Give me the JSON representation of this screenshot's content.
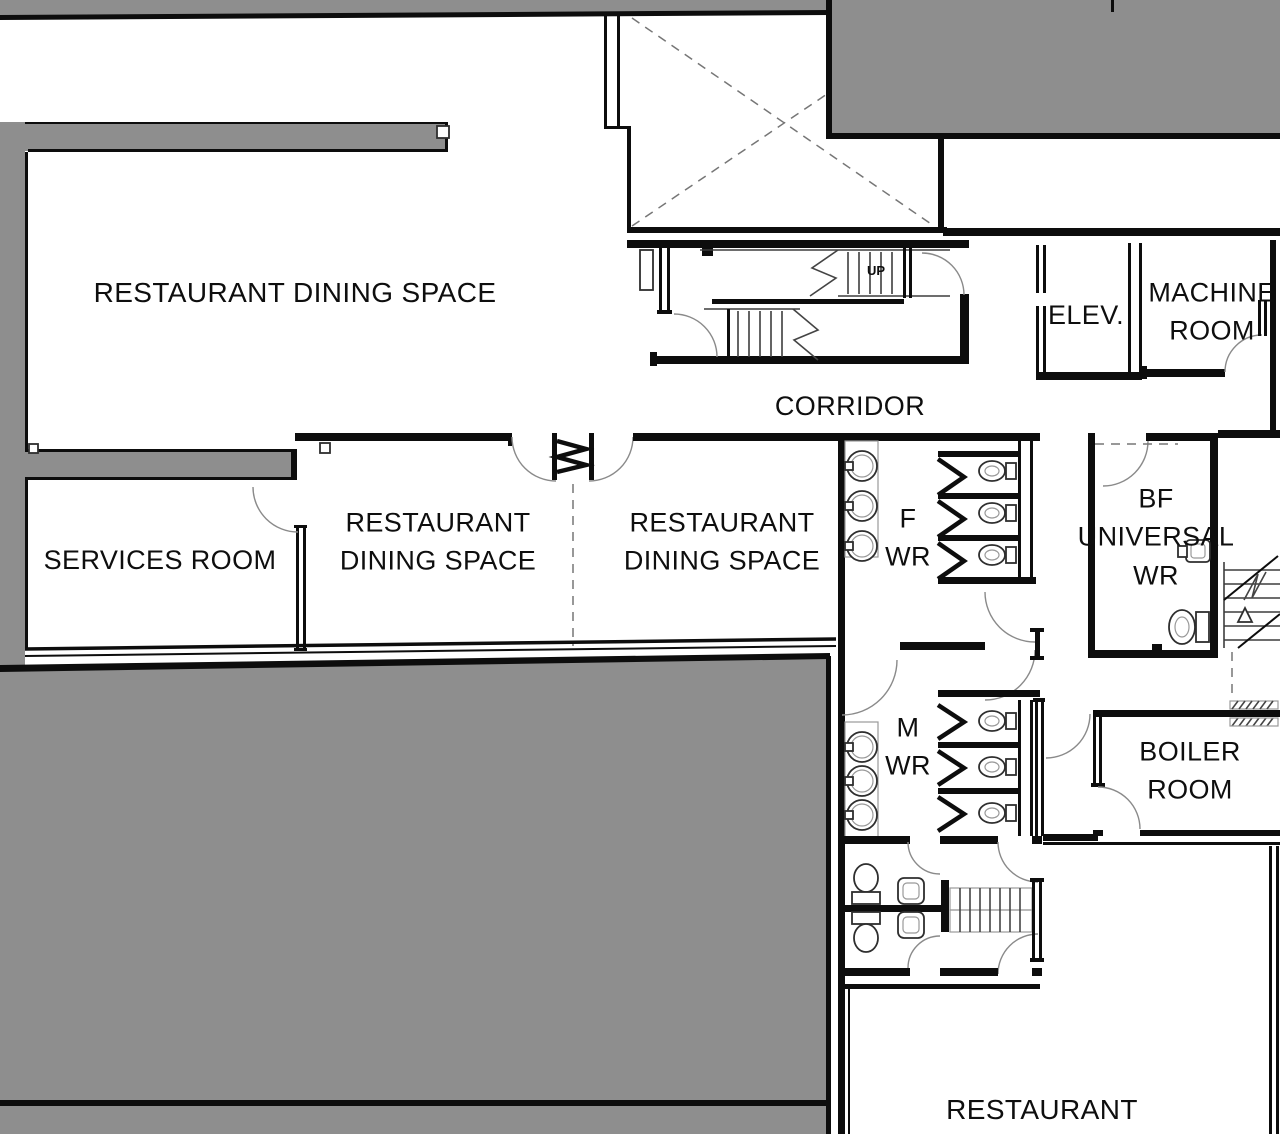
{
  "colors": {
    "wall": "#0d0d0d",
    "mass": "#8e8e8e",
    "background": "#ffffff"
  },
  "labels": {
    "dining_top": {
      "text": "RESTAURANT DINING SPACE"
    },
    "services": {
      "text": "SERVICES ROOM"
    },
    "dining_left": {
      "text": "RESTAURANT\nDINING SPACE"
    },
    "dining_right": {
      "text": "RESTAURANT\nDINING SPACE"
    },
    "corridor": {
      "text": "CORRIDOR"
    },
    "elevator": {
      "text": "ELEV."
    },
    "machine_room": {
      "text": "MACHINE\nROOM"
    },
    "f_wr": {
      "text": "F\nWR"
    },
    "bf_universal_wr": {
      "text": "BF\nUNIVERSAL\nWR"
    },
    "m_wr": {
      "text": "M\nWR"
    },
    "boiler_room": {
      "text": "BOILER\nROOM"
    },
    "restaurant": {
      "text": "RESTAURANT"
    },
    "stair_direction": {
      "text": "UP"
    }
  }
}
